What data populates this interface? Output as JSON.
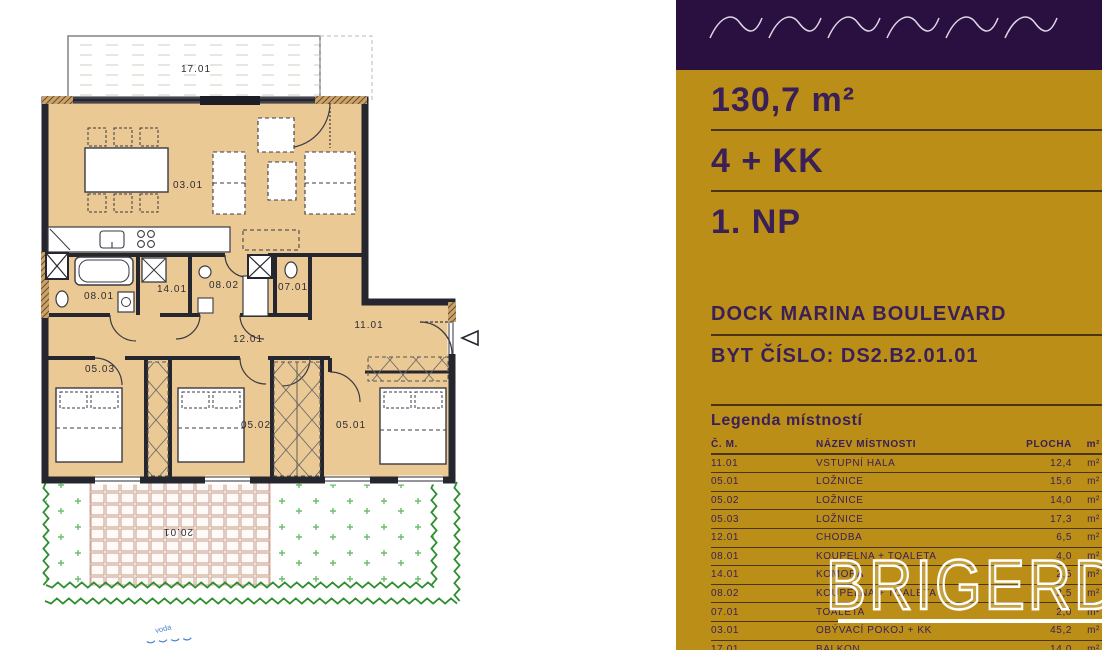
{
  "panel": {
    "area": "130,7 m²",
    "layout": "4 + KK",
    "floor": "1. NP",
    "project": "DOCK MARINA BOULEVARD",
    "unit": "BYT ČÍSLO: DS2.B2.01.01",
    "legend_title": "Legenda místností",
    "columns": {
      "code": "Č. M.",
      "name": "NÁZEV MÍSTNOSTI",
      "area": "PLOCHA",
      "unit": "m²"
    },
    "rows": [
      {
        "code": "11.01",
        "name": "VSTUPNÍ HALA",
        "area": "12,4",
        "unit": "m²"
      },
      {
        "code": "05.01",
        "name": "LOŽNICE",
        "area": "15,6",
        "unit": "m²"
      },
      {
        "code": "05.02",
        "name": "LOŽNICE",
        "area": "14,0",
        "unit": "m²"
      },
      {
        "code": "05.03",
        "name": "LOŽNICE",
        "area": "17,3",
        "unit": "m²"
      },
      {
        "code": "12.01",
        "name": "CHODBA",
        "area": "6,5",
        "unit": "m²"
      },
      {
        "code": "08.01",
        "name": "KOUPELNA + TOALETA",
        "area": "4,0",
        "unit": "m²"
      },
      {
        "code": "14.01",
        "name": "KOMORA",
        "area": "2,5",
        "unit": "m²"
      },
      {
        "code": "08.02",
        "name": "KOUPELNA + TOALETA",
        "area": "2,5",
        "unit": "m²"
      },
      {
        "code": "07.01",
        "name": "TOALETA",
        "area": "2,0",
        "unit": "m²"
      },
      {
        "code": "03.01",
        "name": "OBÝVACÍ POKOJ + KK",
        "area": "45,2",
        "unit": "m²"
      },
      {
        "code": "17.01",
        "name": "BALKON",
        "area": "14,0",
        "unit": "m²"
      },
      {
        "code": "20.01",
        "name": "PŘEDZAHRÁDKA",
        "area": "48,4",
        "unit": "m²"
      }
    ],
    "colors": {
      "gold": "#bb8e17",
      "purple": "#2a1040",
      "text": "#3a2057",
      "rule": "#4a3413"
    }
  },
  "plan": {
    "labels": {
      "balcony": "17.01",
      "living": "03.01",
      "bath1": "08.01",
      "storage": "14.01",
      "bath2": "08.02",
      "wc": "07.01",
      "hall": "11.01",
      "corridor": "12.01",
      "bed3": "05.03",
      "bed2": "05.02",
      "bed1": "05.01",
      "garden": "20.01",
      "water_note": "voda"
    },
    "colors": {
      "room_fill": "#ebc994",
      "wall": "#26262f",
      "garden_green": "#2f8f2f",
      "tile": "#c99a8a",
      "water_blue": "#4a7fd4"
    }
  },
  "watermark": "BRIGERD"
}
